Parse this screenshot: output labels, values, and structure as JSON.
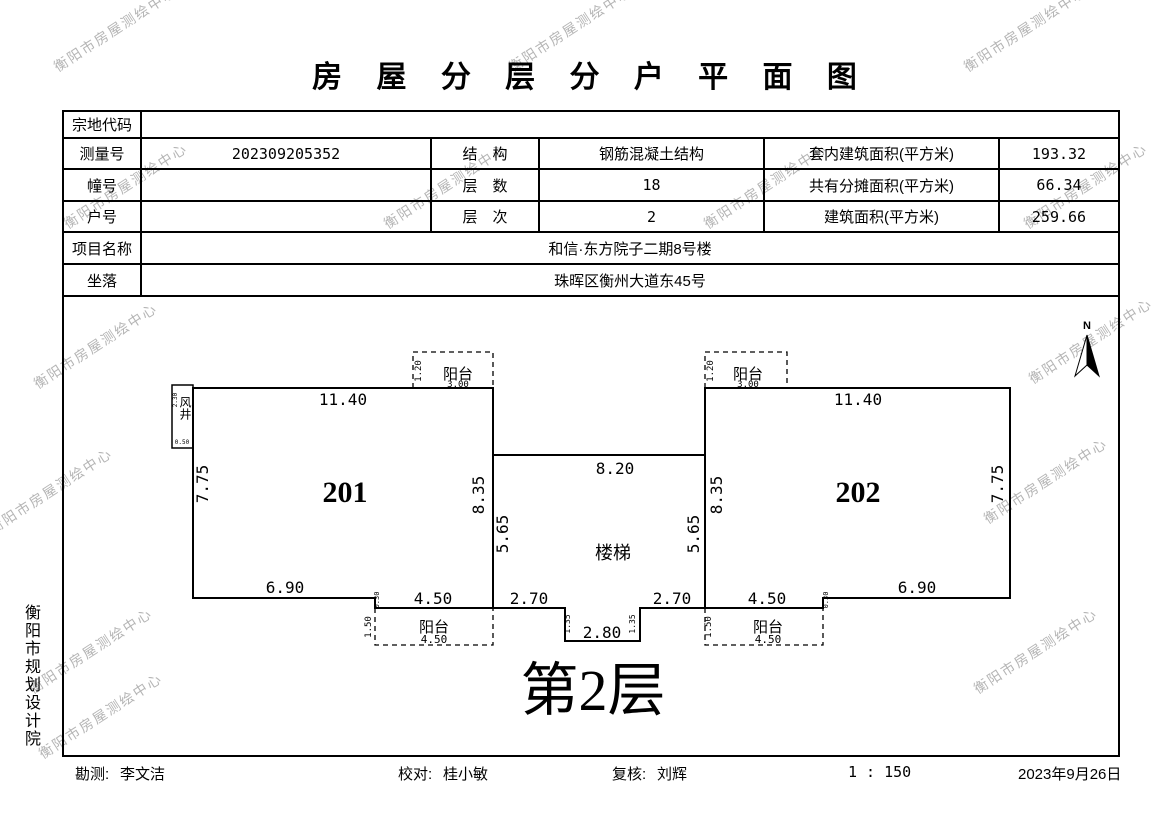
{
  "title": "房 屋 分 层 分 户 平 面 图",
  "watermark": {
    "text": "衡阳市房屋测绘中心"
  },
  "table": {
    "parcel_code_label": "宗地代码",
    "parcel_code_value": "",
    "survey_no_label": "测量号",
    "survey_no_value": "202309205352",
    "structure_label": "结　构",
    "structure_value": "钢筋混凝土结构",
    "inner_area_label": "套内建筑面积(平方米)",
    "inner_area_value": "193.32",
    "building_no_label": "幢号",
    "building_no_value": "",
    "floors_label": "层　数",
    "floors_value": "18",
    "shared_area_label": "共有分摊面积(平方米)",
    "shared_area_value": "66.34",
    "unit_no_label": "户号",
    "unit_no_value": "",
    "level_label": "层　次",
    "level_value": "2",
    "total_area_label": "建筑面积(平方米)",
    "total_area_value": "259.66",
    "project_label": "项目名称",
    "project_value": "和信·东方院子二期8号楼",
    "location_label": "坐落",
    "location_value": "珠晖区衡州大道东45号"
  },
  "plan": {
    "north_label": "N",
    "floor_label": "第2层",
    "stairs_label": "楼梯",
    "balcony_label": "阳台",
    "units": {
      "left": "201",
      "right": "202"
    },
    "shaft": {
      "label": "风井",
      "dim_h": "2.30",
      "dim_w": "0.50"
    },
    "dims": {
      "unit_top_width": "11.40",
      "unit_outer_height": "7.75",
      "unit_bottom_width": "6.90",
      "unit_inner_height": "8.35",
      "stair_side_height": "5.65",
      "stair_top_width": "8.20",
      "stair_bottom_side": "2.70",
      "stair_notch_width": "2.80",
      "stair_notch_depth": "1.35",
      "balcony_bottom_width": "4.50",
      "balcony_bottom_depth": "1.50",
      "balcony_top_width": "3.00",
      "balcony_top_depth": "1.20",
      "wall_step": "0.30"
    }
  },
  "side_text": "衡阳市规划设计院",
  "footer": {
    "survey_label": "勘测:",
    "survey_name": "李文洁",
    "check_label": "校对:",
    "check_name": "桂小敏",
    "review_label": "复核:",
    "review_name": "刘辉",
    "scale": "1 : 150",
    "date": "2023年9月26日"
  }
}
